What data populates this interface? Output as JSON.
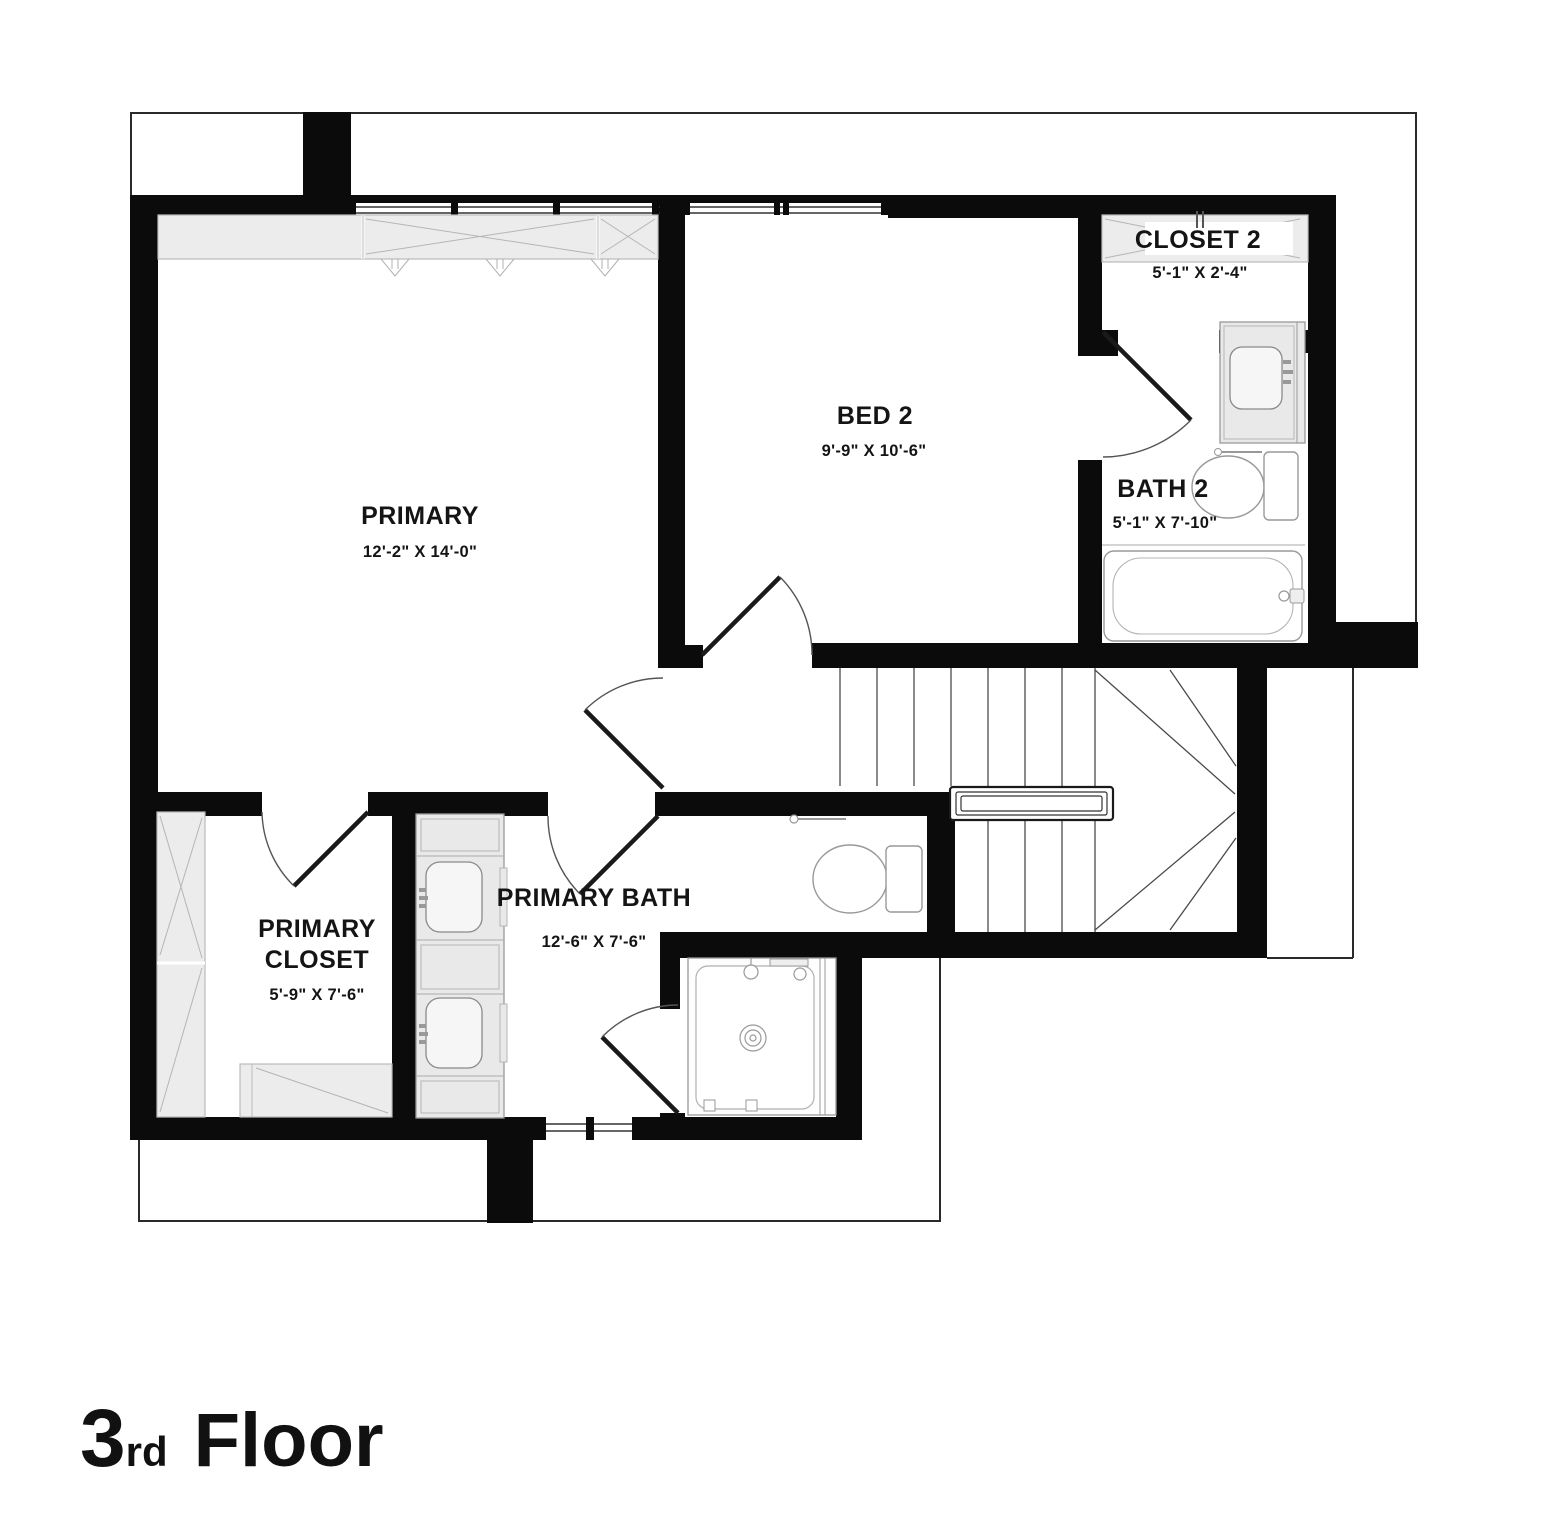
{
  "title": {
    "number": "3",
    "suffix": "rd",
    "word": "Floor"
  },
  "rooms": {
    "primary": {
      "name": "PRIMARY",
      "dims": "12'-2\" X 14'-0\""
    },
    "bed2": {
      "name": "BED 2",
      "dims": "9'-9\" X 10'-6\""
    },
    "closet2": {
      "name": "CLOSET 2",
      "dims": "5'-1\" X 2'-4\""
    },
    "bath2": {
      "name": "BATH 2",
      "dims": "5'-1\" X 7'-10\""
    },
    "primary_bath": {
      "name": "PRIMARY BATH",
      "dims": "12'-6\" X 7'-6\""
    },
    "primary_closet": {
      "name_line1": "PRIMARY",
      "name_line2": "CLOSET",
      "dims": "5'-9\" X 7'-6\""
    }
  },
  "colors": {
    "wall": "#0b0b0b",
    "shelf_fill": "#ececec",
    "fixture_line": "#999999",
    "background": "#ffffff"
  }
}
